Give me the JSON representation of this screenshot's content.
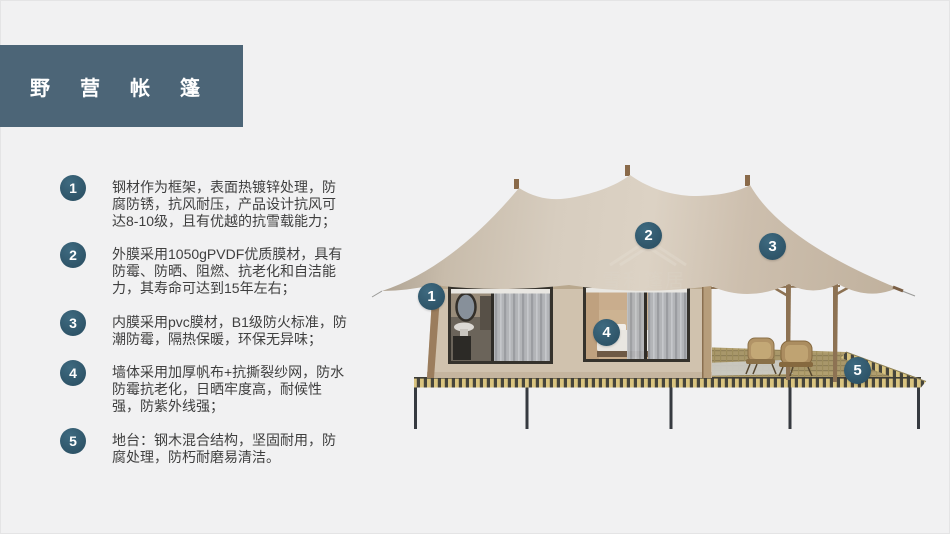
{
  "slide": {
    "title": "野营帐篷",
    "watermark": "雪利篷居"
  },
  "features": [
    {
      "num": "1",
      "text": "钢材作为框架，表面热镀锌处理，防腐防锈，抗风耐压，产品设计抗风可达8-10级，且有优越的抗雪载能力；"
    },
    {
      "num": "2",
      "text": "外膜采用1050gPVDF优质膜材，具有防霉、防晒、阻燃、抗老化和自洁能力，其寿命可达到15年左右；"
    },
    {
      "num": "3",
      "text": "内膜采用pvc膜材，B1级防火标准，防潮防霉，隔热保暖，环保无异味；"
    },
    {
      "num": "4",
      "text": "墙体采用加厚帆布+抗撕裂纱网，防水防霉抗老化，日晒牢度高，耐候性强，防紫外线强；"
    },
    {
      "num": "5",
      "text": "地台：钢木混合结构，坚固耐用，防腐处理，防朽耐磨易清洁。"
    }
  ],
  "image_markers": [
    {
      "label": "1"
    },
    {
      "label": "2"
    },
    {
      "label": "3"
    },
    {
      "label": "4"
    },
    {
      "label": "5"
    }
  ],
  "colors": {
    "title-bg": "#4c6577",
    "badge": "#2e5468",
    "text": "#3f3f3f",
    "page-bg": "#f1f1f2",
    "roof": "#d2c7b8",
    "wall": "#d0c2ae",
    "deck-stripe-tan": "#d9c480",
    "deck-stripe-dark": "#46453c"
  }
}
